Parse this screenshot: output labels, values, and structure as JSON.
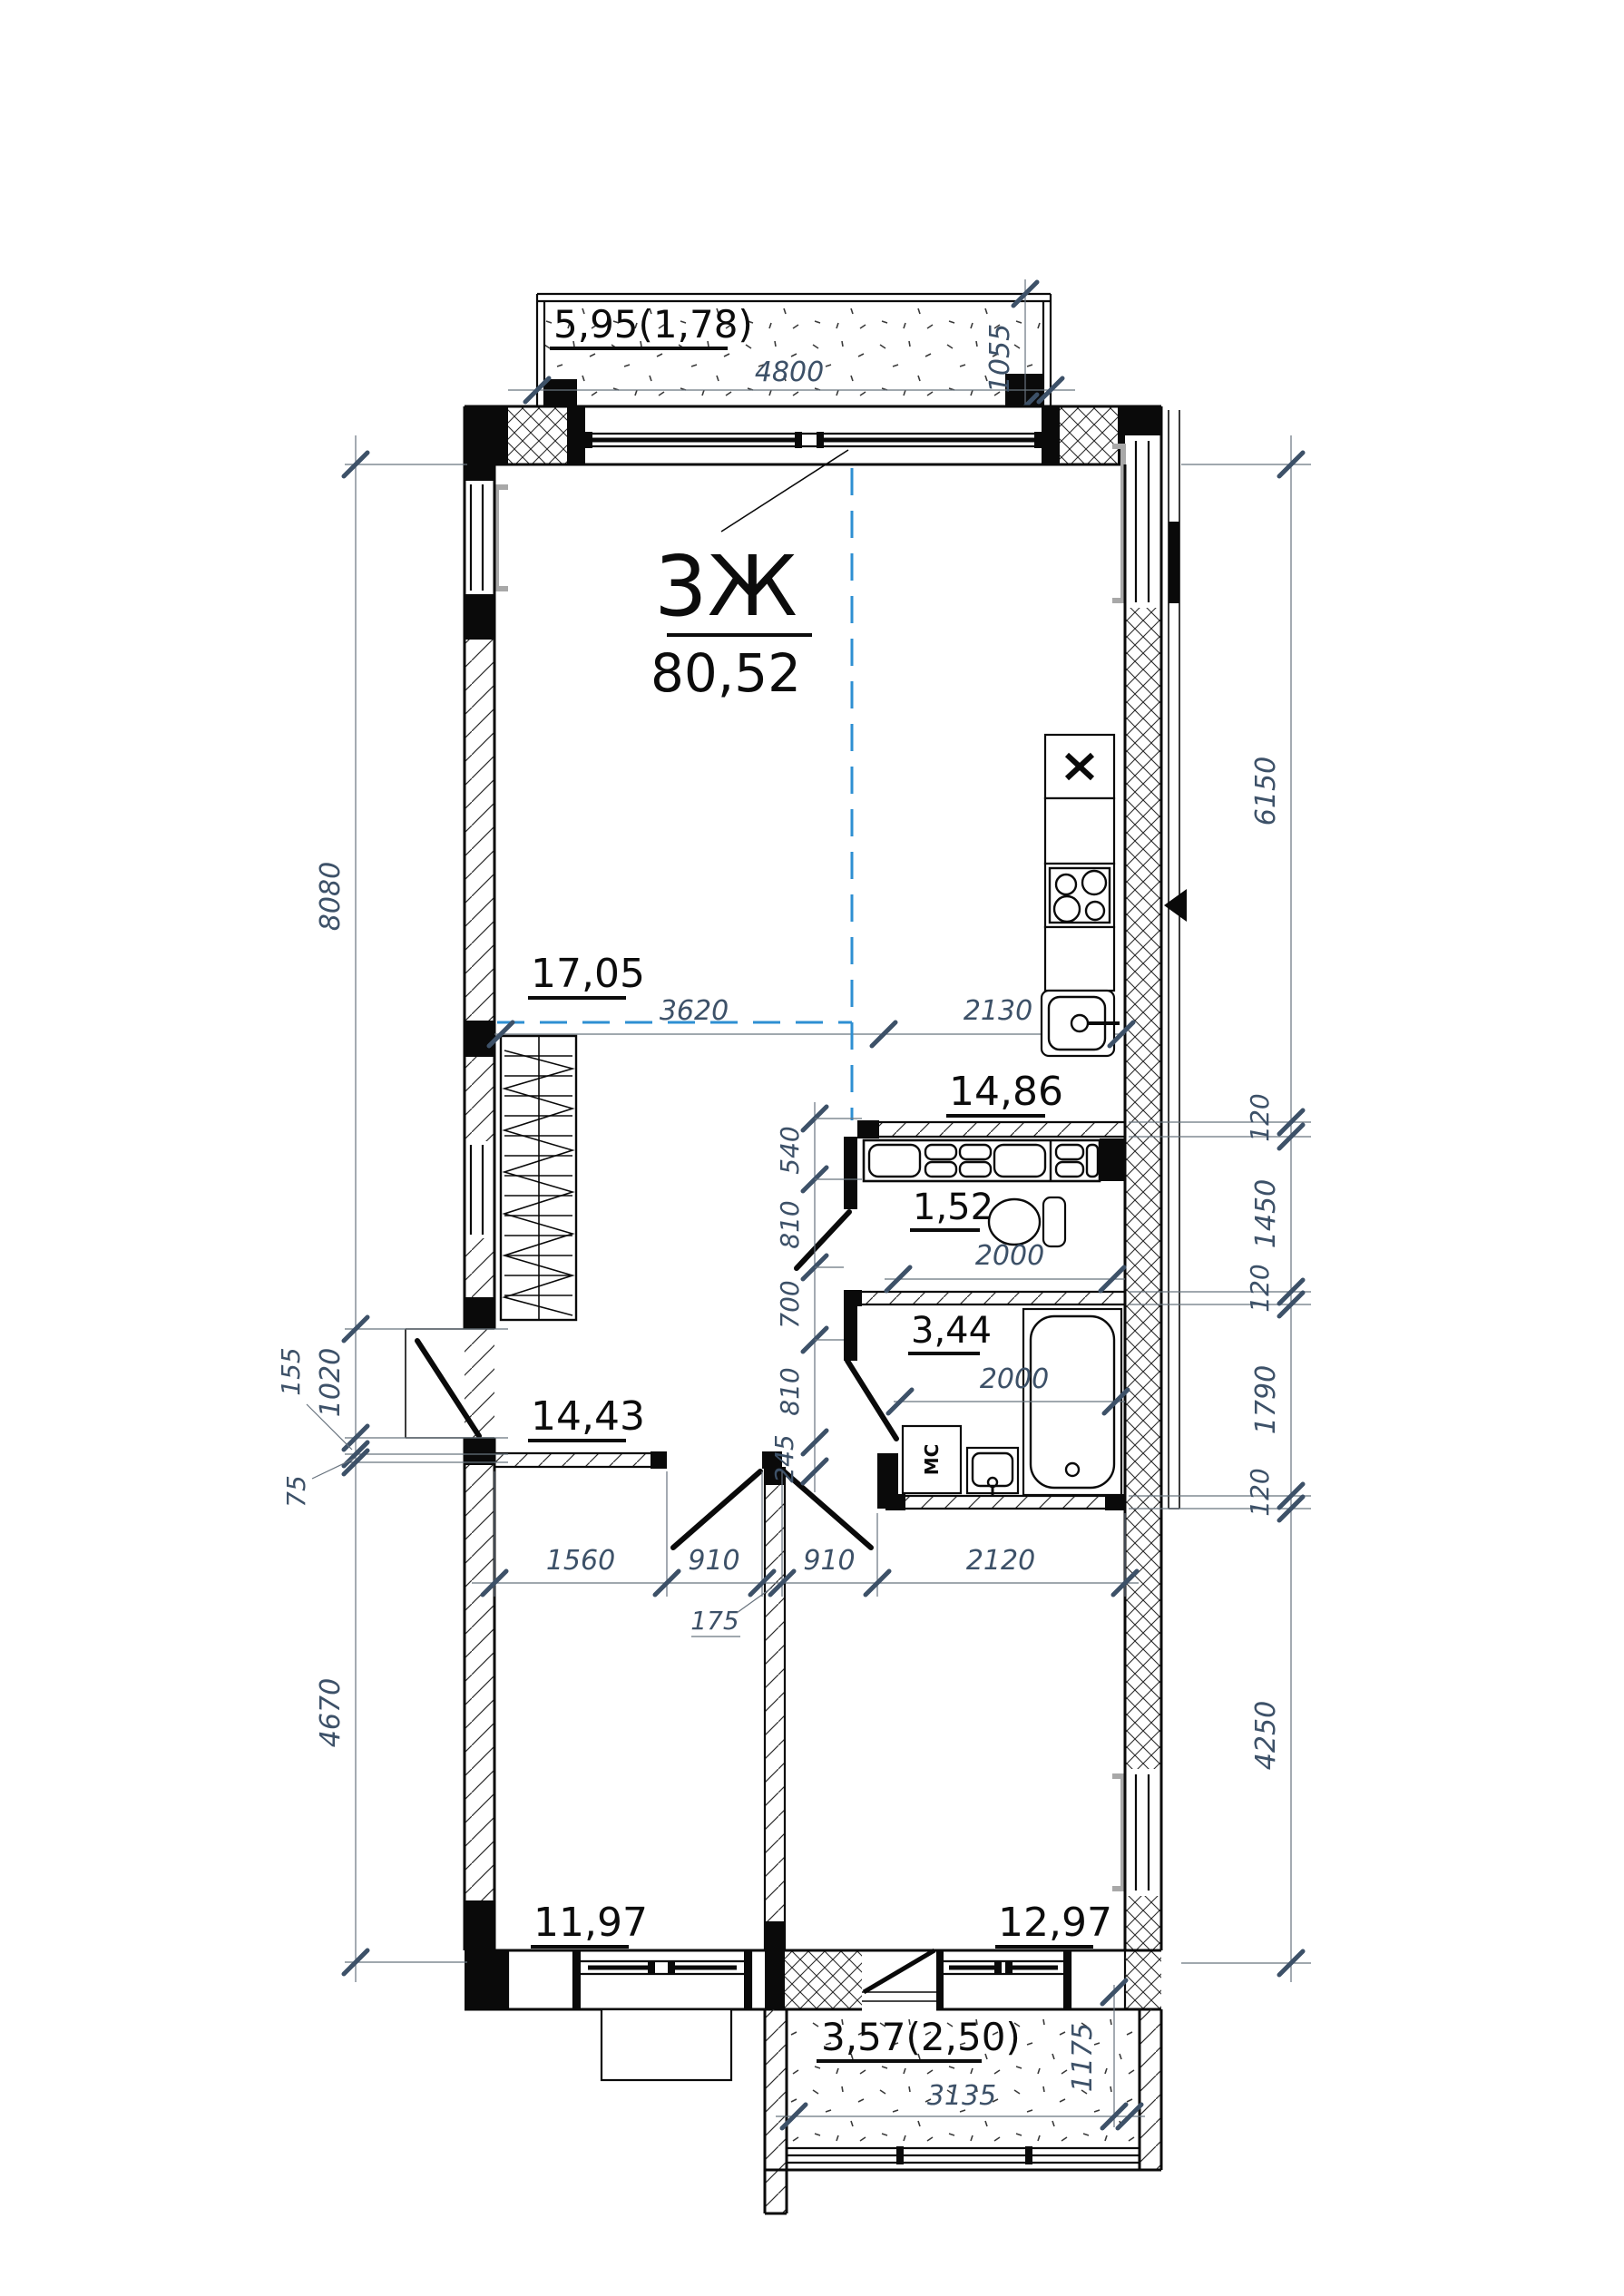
{
  "title": {
    "unit_type": "3Ж",
    "total_area": "80,52"
  },
  "rooms": {
    "living": "17,05",
    "kitchen": "14,86",
    "wc": "1,52",
    "bathroom": "3,44",
    "hallway": "14,43",
    "bedroom_left": "11,97",
    "bedroom_right": "12,97"
  },
  "balconies": {
    "top": {
      "label": "5,95(1,78)",
      "width": "4800",
      "depth": "1055"
    },
    "bottom": {
      "label": "3,57(2,50)",
      "width": "3135",
      "depth": "1175"
    }
  },
  "dimensions": {
    "left": {
      "d1": "8080",
      "d2": "1020",
      "d3": "155",
      "d4": "75",
      "d5": "4670"
    },
    "right": {
      "d1": "6150",
      "d2": "120",
      "d3": "1450",
      "d4": "120",
      "d5": "1790",
      "d6": "120",
      "d7": "4250"
    },
    "interior_top": {
      "d1": "3620",
      "d2": "2130"
    },
    "interior_vertical": {
      "d1": "540",
      "d2": "810",
      "d3": "700",
      "d4": "810",
      "d5": "245"
    },
    "wc_width": "2000",
    "bathroom_width": "2000",
    "interior_bottom": {
      "d1": "1560",
      "d2": "910",
      "d3": "175",
      "d4": "910",
      "d5": "2120"
    }
  },
  "fixtures": {
    "washing_machine": "МС"
  },
  "colors": {
    "dimension_text": "#3d5168",
    "axis_blue": "#2e8fd2",
    "wall_black": "#0a0a0a",
    "reveal_gray": "#a8a8a8",
    "line_gray": "#68737e"
  }
}
